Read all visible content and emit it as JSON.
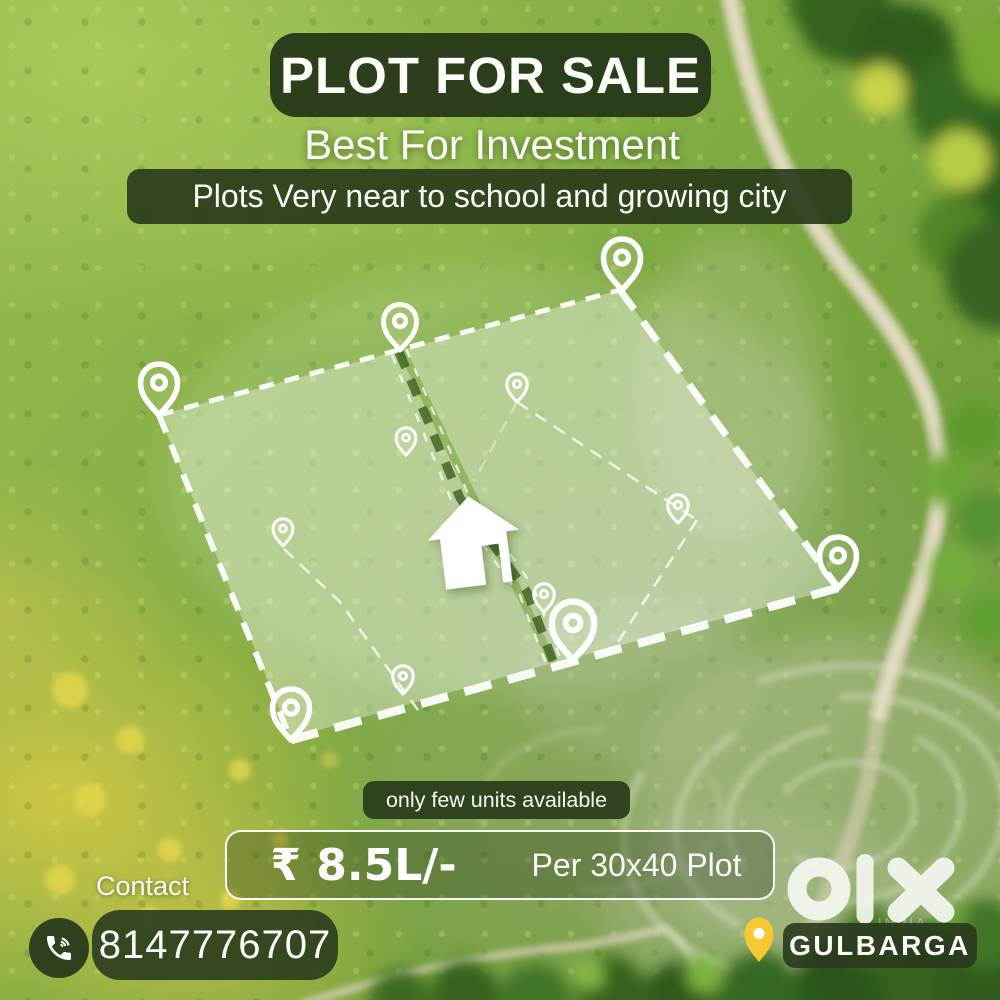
{
  "poster": {
    "title": "PLOT FOR SALE",
    "subtitle": "Best For Investment",
    "tagline": "Plots Very near to school and growing city",
    "availability": "only few units available",
    "price": {
      "amount": "₹ 8.5L/-",
      "per": "Per 30x40 Plot"
    },
    "contact": {
      "label": "Contact",
      "phone": "8147776707"
    },
    "brand": {
      "name": "olx",
      "watermark": "INDIA"
    },
    "location": "GULBARGA",
    "colors": {
      "panel_dark_green": "#2b3d1e",
      "accent_yellow": "#f6c832",
      "text_white": "#ffffff",
      "field_green": "#85ae45"
    },
    "icons": {
      "phone": "phone-call-icon",
      "location": "location-pin-icon",
      "house": "house-icon",
      "plot_marker": "map-pin-outline-icon",
      "brand_logo": "olx-logo"
    }
  }
}
